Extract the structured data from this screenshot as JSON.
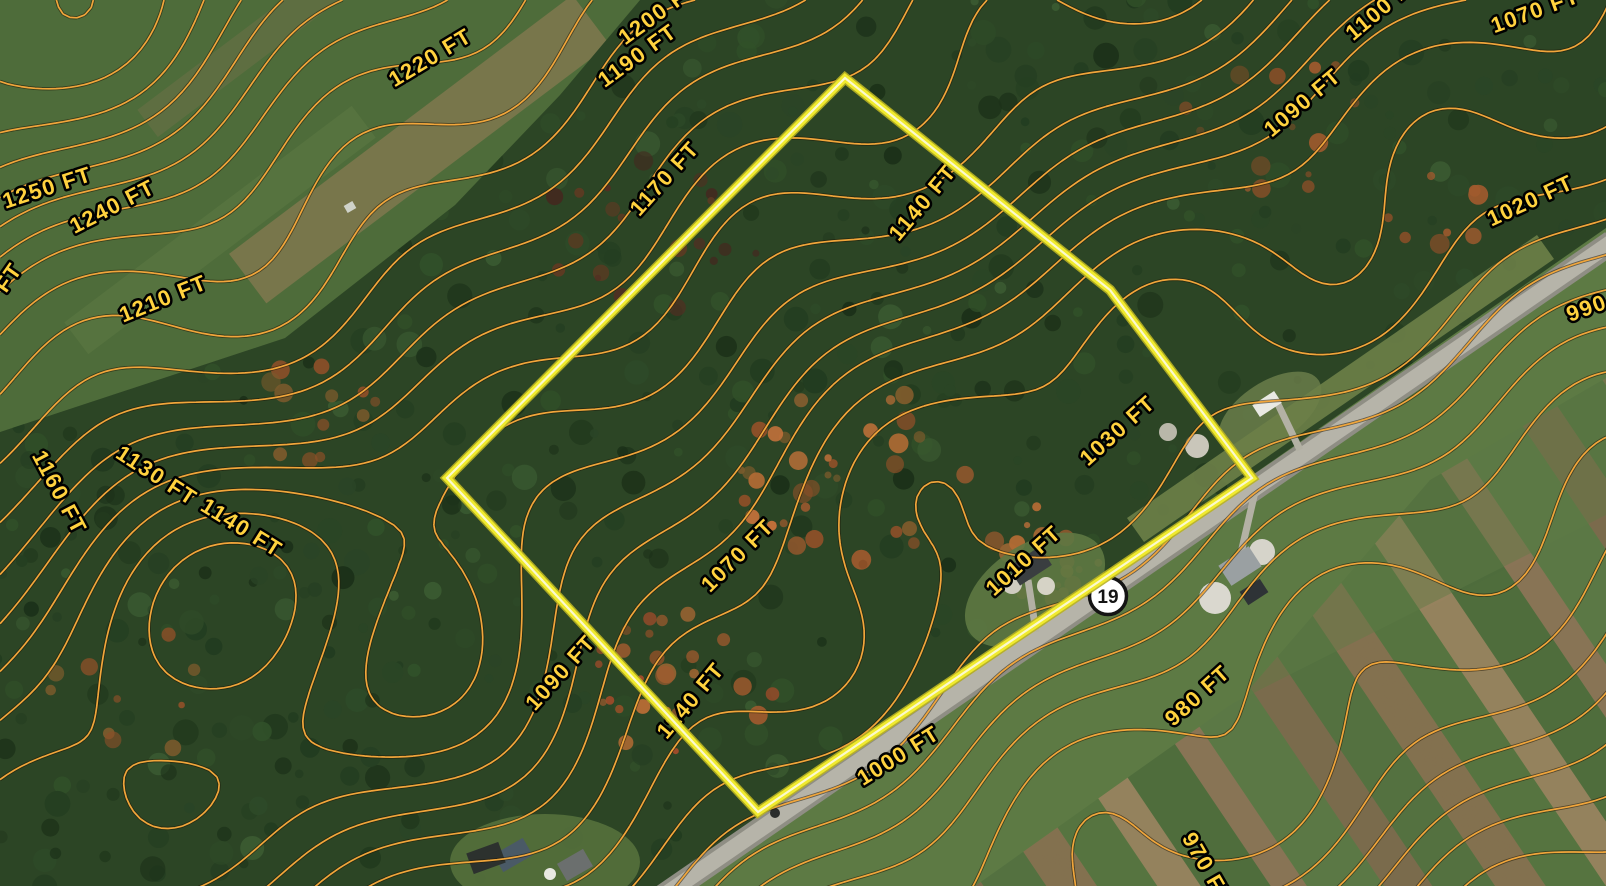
{
  "map": {
    "kind": "satellite-with-contour-overlay",
    "elevation_unit": "FT",
    "contour_interval_ft": 10
  },
  "route_marker": {
    "number": "19",
    "x": 1108,
    "y": 596,
    "radius": 18.5
  },
  "parcel_boundary": {
    "vertices": [
      [
        845,
        78
      ],
      [
        1110,
        290
      ],
      [
        1252,
        478
      ],
      [
        758,
        812
      ],
      [
        447,
        478
      ]
    ]
  },
  "contour_labels": [
    {
      "text": "1250 FT",
      "x": 47,
      "y": 187,
      "rot": -18
    },
    {
      "text": "1240 FT",
      "x": 112,
      "y": 206,
      "rot": -27
    },
    {
      "text": "1220 FT",
      "x": 430,
      "y": 57,
      "rot": -31
    },
    {
      "text": "1200 FT",
      "x": 658,
      "y": 12,
      "rot": -36
    },
    {
      "text": "1190 FT",
      "x": 637,
      "y": 55,
      "rot": -36
    },
    {
      "text": "1170 FT",
      "x": 664,
      "y": 178,
      "rot": -48
    },
    {
      "text": "1140 FT",
      "x": 922,
      "y": 202,
      "rot": -50
    },
    {
      "text": "1100 FT",
      "x": 1383,
      "y": 6,
      "rot": -40
    },
    {
      "text": "1070 FT",
      "x": 1535,
      "y": 10,
      "rot": -20
    },
    {
      "text": "1090 FT",
      "x": 1302,
      "y": 102,
      "rot": -40
    },
    {
      "text": "1020 FT",
      "x": 1530,
      "y": 200,
      "rot": -25
    },
    {
      "text": "990 FT",
      "x": 1604,
      "y": 301,
      "rot": -20
    },
    {
      "text": "1210 FT",
      "x": 163,
      "y": 298,
      "rot": -22
    },
    {
      "text": "1160 FT",
      "x": 60,
      "y": 492,
      "rot": 62
    },
    {
      "text": "1130 FT",
      "x": 157,
      "y": 475,
      "rot": 33
    },
    {
      "text": "1140 FT",
      "x": 242,
      "y": 527,
      "rot": 32
    },
    {
      "text": "1030 FT",
      "x": 1117,
      "y": 430,
      "rot": -42
    },
    {
      "text": "1070 FT",
      "x": 737,
      "y": 555,
      "rot": -45
    },
    {
      "text": "1010 FT",
      "x": 1023,
      "y": 560,
      "rot": -42
    },
    {
      "text": "1090 FT",
      "x": 560,
      "y": 672,
      "rot": -48
    },
    {
      "text": "1140 FT",
      "x": 690,
      "y": 700,
      "rot": -50
    },
    {
      "text": "1000 FT",
      "x": 898,
      "y": 755,
      "rot": -32
    },
    {
      "text": "980 FT",
      "x": 1197,
      "y": 695,
      "rot": -42
    },
    {
      "text": "970 FT",
      "x": 1208,
      "y": 868,
      "rot": 60
    },
    {
      "text": "FT",
      "x": 8,
      "y": 277,
      "rot": -55
    }
  ],
  "colors": {
    "contour_line": "#f1a63b",
    "contour_halo": "#1e1506",
    "label_fill": "#ffd23e",
    "label_stroke": "#000000",
    "parcel_outer": "#b9b324",
    "parcel_main": "#f0ea2d",
    "parcel_core": "#fbf9cf",
    "marker_fill": "#ffffff",
    "marker_border": "#141414",
    "marker_text": "#141414",
    "road_fill": "#b6b4a9",
    "road_edge": "#8f8e84"
  }
}
